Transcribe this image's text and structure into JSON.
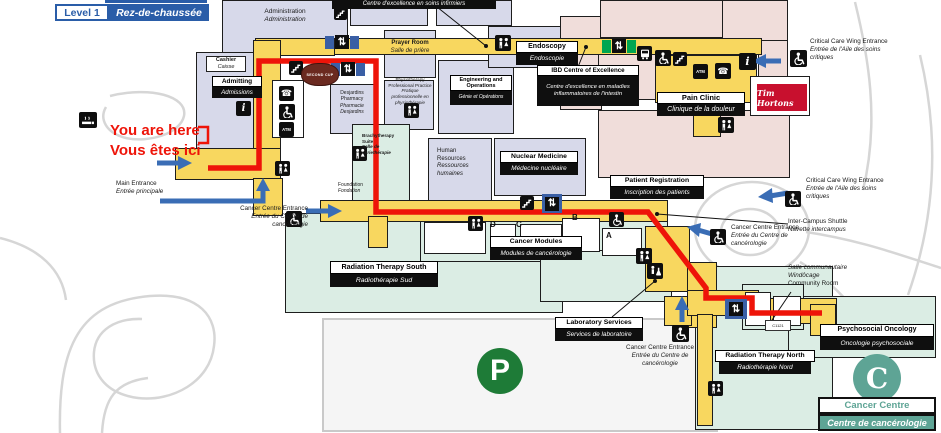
{
  "header": {
    "level_en": "Level 1",
    "level_fr": "Rez-de-chaussée"
  },
  "marker": {
    "line1": "You are here",
    "line2": "Vous êtes ici"
  },
  "rooms": {
    "administration": {
      "en": "Administration",
      "fr": "Administration"
    },
    "cashier": {
      "en": "Cashier",
      "fr": "Caisse"
    },
    "admitting": {
      "en": "Admitting",
      "fr": "Admissions"
    },
    "desjardins_pharmacy": {
      "en": "Desjardins Pharmacy",
      "fr": "Pharmacie Desjardins"
    },
    "nursing_excellence": {
      "fr": "Centre d'excellence en soins infirmiers"
    },
    "prayer_room": {
      "en": "Prayer Room",
      "fr": "Salle de prière"
    },
    "physiotherapy": {
      "en": "Physiotherapy Professional Practice",
      "fr": "Pratique professionnelle en physiothérapie"
    },
    "engineering": {
      "en": "Engineering and Operations",
      "fr": "Génie et Opérations"
    },
    "endoscopy": {
      "en": "Endoscopy",
      "fr": "Endoscopie"
    },
    "ibd_centre": {
      "en": "IBD Centre of Excellence",
      "fr": "Centre d'excellence en maladies inflammatoires de l'intestin"
    },
    "pain_clinic": {
      "en": "Pain Clinic",
      "fr": "Clinique de la douleur"
    },
    "human_resources": {
      "en": "Human Resources",
      "fr": "Ressources humaines"
    },
    "brachytherapy": {
      "en": "Brachytherapy Suite",
      "fr": "Salle de curiethérapie"
    },
    "nuclear_medicine": {
      "en": "Nuclear Medicine",
      "fr": "Médecine nucléaire"
    },
    "patient_registration": {
      "en": "Patient Registration",
      "fr": "Inscription des patients"
    },
    "foundation": {
      "en": "Foundation",
      "fr": "Fondation"
    },
    "cancer_modules": {
      "en": "Cancer Modules",
      "fr": "Modules de cancérologie"
    },
    "radiation_south": {
      "en": "Radiation Therapy South",
      "fr": "Radiothérapie Sud"
    },
    "laboratory": {
      "en": "Laboratory Services",
      "fr": "Services de laboratoire"
    },
    "radiation_north": {
      "en": "Radiation Therapy North",
      "fr": "Radiothérapie Nord"
    },
    "psychosocial_oncology": {
      "en": "Psychosocial Oncology",
      "fr": "Oncologie psychosociale"
    },
    "community_room": {
      "fr": "Salle communautaire",
      "name": "Windôcage",
      "en": "Community Room"
    },
    "room_number": "C1121"
  },
  "modules": {
    "letters": [
      "D",
      "C",
      "B",
      "A"
    ]
  },
  "entrances": {
    "main": {
      "en": "Main Entrance",
      "fr": "Entrée principale"
    },
    "cancer_left": {
      "en": "Cancer Centre Entrance",
      "fr": "Entrée du Centre de cancérologie"
    },
    "cancer_right": {
      "en": "Cancer Centre Entrance",
      "fr": "Entrée du Centre de cancérologie"
    },
    "cancer_bottom": {
      "en": "Cancer Centre Entrance",
      "fr": "Entrée du Centre de cancérologie"
    },
    "critical_care_top": {
      "en": "Critical Care Wing Entrance",
      "fr": "Entrée de l'Aile des soins critiques"
    },
    "critical_care_right": {
      "en": "Critical Care Wing Entrance",
      "fr": "Entrée de l'Aile des soins critiques"
    },
    "shuttle": {
      "en": "Inter-Campus Shuttle",
      "fr": "Navette intercampus"
    }
  },
  "brands": {
    "tim_hortons": "Tim Hortons",
    "second_cup": "SECOND CUP"
  },
  "cancer_centre_logo": {
    "letter": "C",
    "en": "Cancer Centre",
    "fr": "Centre de cancérologie"
  },
  "parking": {
    "symbol": "P"
  },
  "icon_glyphs": {
    "atm": "ATM",
    "info": "i",
    "phone": "☎",
    "elevator": "⇅"
  },
  "route": {
    "points": "208,168 259,168 259,61 376,61 376,212 648,212 706,288 706,298 752,298 752,313 822,313",
    "marker_bracket": "198,127 208,127 208,143 198,143"
  },
  "arrows": {
    "main_upper": {
      "line": "157,163 179,163",
      "head": "178,156 192,163 178,170"
    },
    "main_lower": {
      "line": "160,201 263,201 263,190",
      "head": "256,191 263,178 270,191"
    },
    "foundation": {
      "line": "306,211 329,211",
      "head": "328,204 342,211 328,218"
    },
    "critical_top": {
      "line": "781,61 765,61",
      "head": "766,54 752,61 766,68"
    },
    "critical_right": {
      "line": "788,193 770,196",
      "head": "772,188 758,197 773,203"
    },
    "cancer_right": {
      "line": "712,234 698,230",
      "head": "701,223 687,227 699,237"
    },
    "cancer_bottom": {
      "line": "682,322 682,309",
      "head": "675,310 682,296 689,310"
    }
  },
  "colors": {
    "corridor": "#F8D75F",
    "route": "#EE1409",
    "arrow": "#3A6DB5",
    "lavender": "#D7D9EA",
    "mint": "#DBEDE4",
    "pink": "#F0DDDA",
    "teal": "#5EA495",
    "parking_green": "#1E7B37",
    "tim_red": "#C8102E",
    "cup_maroon": "#6B2A20",
    "header_blue": "#2A5DA8",
    "road_gray": "#D6D6D6",
    "wall": "#1D1D1D"
  }
}
